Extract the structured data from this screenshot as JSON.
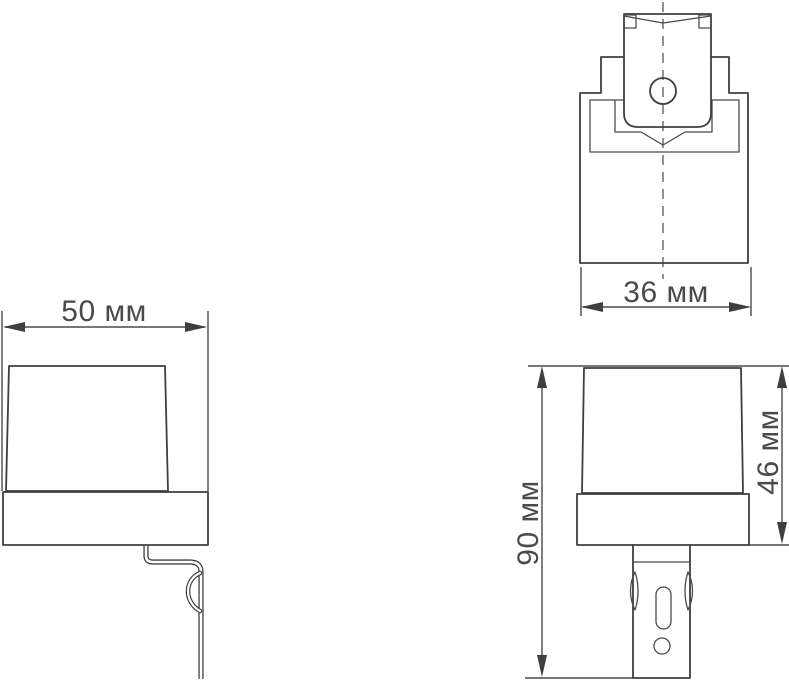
{
  "page": {
    "background": "#ffffff"
  },
  "drawing": {
    "unit": "мм",
    "colors": {
      "line": "#3f3f3f",
      "text": "#4a4a4a"
    },
    "dimensions": {
      "top_view_depth": {
        "value": 36,
        "label": "36 мм"
      },
      "side_width": {
        "value": 50,
        "label": "50 мм"
      },
      "total_height": {
        "value": 90,
        "label": "90 мм"
      },
      "upper_body_height": {
        "value": 46,
        "label": "46 мм"
      }
    }
  }
}
